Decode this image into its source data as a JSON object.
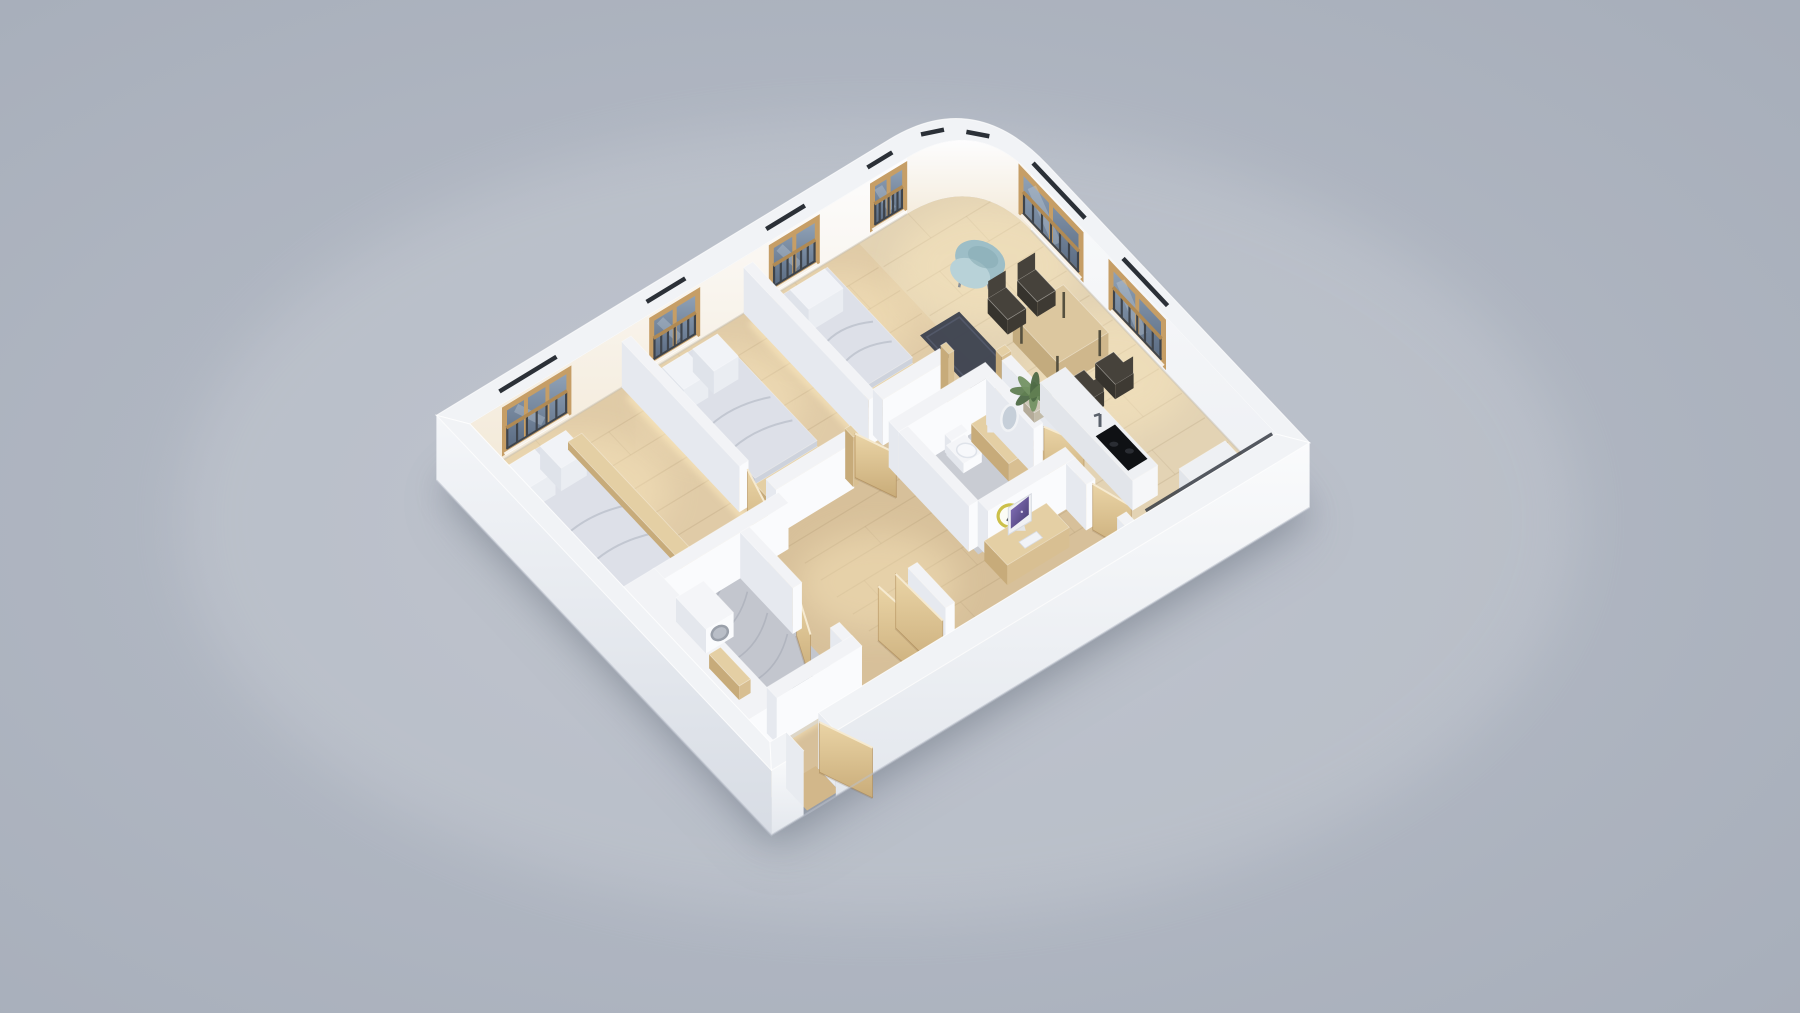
{
  "meta": {
    "view": "isometric-dollhouse-floor-plan-render",
    "content": "3d rendered apartment floor plan on plain gray backdrop, no text or ui chrome visible"
  },
  "palette": {
    "bgEdge": "#a6adb9",
    "bgMid": "#b8bec9",
    "bgLight": "#d8dbe0",
    "shadow": "#59626f",
    "plate": "#d8c3a0",
    "floorLiving": "#e3d3b4",
    "floorBed": "#e0cba7",
    "floorHall": "#d7c09a",
    "floorMarble": "#c3c6ce",
    "floorBath1": "#c9ccd3",
    "plank": "#8d7452",
    "veins": "#9fa3af",
    "glowWarm": "#ffedc2",
    "rug": "#3d4350",
    "rugLine": "#565d6e",
    "ringTop": "#f1f3f6",
    "nwFaceTop": "#fdfdfe",
    "nwFaceBot": "#f3e9d7",
    "neFaceTop": "#f9fafb",
    "neFaceBot": "#eef0f4",
    "swFaceTop": "#f4f6f9",
    "swFaceBot": "#d7dce4",
    "seFaceTop": "#fafbfc",
    "seFaceBot": "#e3e7ed",
    "glassTop": "#93a5ba",
    "glassBot": "#57687f",
    "frameWood": "#c69e66",
    "frameWoodDark": "#a98350",
    "railDark": "#3e444c",
    "railWood": "#b08a54",
    "lintel": "#2b3037",
    "wallTop": "#f2f3f6",
    "wallLeft": "#e6e9ef",
    "wallRight": "#fafbfd",
    "woodTop": "#e4cfa4",
    "woodLeft": "#c7ab7a",
    "woodRight": "#d8bf92",
    "marbleTop": "#eef0f3",
    "marbleLeft": "#e2e5ea",
    "marbleRight": "#f6f7f9",
    "whTop": "#f4f5f8",
    "whLeft": "#e4e7ed",
    "whRight": "#fafbfd",
    "cooktop": "#0f1114",
    "duvTop": "#dde0e8",
    "duvLeft": "#c2c7d3",
    "duvRight": "#cdd2dc",
    "pillow": "#f1f3f7",
    "foldLine": "#b6bcc8",
    "clockRing": "#ccc04a",
    "clockFace": "#fcfcf5",
    "hand": "#3a3f45",
    "screen1": "#8a76c2",
    "screen2": "#43386b",
    "bezel": "#f0f1f4",
    "plantG1": "#4e6a46",
    "plantG2": "#618052",
    "plantG3": "#739263",
    "pot": "#cec7b8",
    "chairDark": "#46423b",
    "chairDarker": "#36332d",
    "armTeal": "#9dbec7",
    "armTealLight": "#b8d2d8",
    "armTealDark": "#85a9b3",
    "woodPanel1": "#ead4a6",
    "woodPanel2": "#c9ac79",
    "stoolTop": "#455469",
    "stoolSide": "#38465a",
    "steel": "#5a616b",
    "threshold": "#d2b78a",
    "washerRing": "#9aa0aa",
    "washerGlass": "#b9bec7"
  },
  "projection": {
    "origin": [
      470,
      480
    ],
    "u_axis": [
      46,
      -28
    ],
    "v_axis": [
      50,
      53
    ],
    "units_long": 11,
    "units_short": 6,
    "wall_lift": 56,
    "wall_thickness": 0.35,
    "curve_start_u": 9.5,
    "curve_end_v": 1.1,
    "entry_gap": [
      0.35,
      1.05
    ]
  },
  "perimeter": {
    "windows_nw": [
      {
        "span": [
          0.75,
          2.15
        ],
        "panes": 3
      },
      {
        "span": [
          3.95,
          4.95
        ],
        "panes": 2
      },
      {
        "span": [
          6.55,
          7.55
        ],
        "panes": 2
      },
      {
        "span": [
          8.75,
          9.45
        ],
        "panes": 2
      }
    ],
    "windows_ne": [
      {
        "span": [
          0.9,
          2.1
        ],
        "panes": 2
      },
      {
        "span": [
          2.7,
          3.75
        ],
        "panes": 2
      }
    ],
    "curve_ticks": [
      [
        10.0,
        -0.18,
        10.38,
        -0.07
      ],
      [
        10.66,
        0.12,
        10.92,
        0.34
      ]
    ]
  },
  "rooms": [
    {
      "id": "living-dining-kitchen",
      "floor": "wood"
    },
    {
      "id": "bedroom-1",
      "floor": "wood"
    },
    {
      "id": "bedroom-2",
      "floor": "wood"
    },
    {
      "id": "bedroom-3-master",
      "floor": "wood"
    },
    {
      "id": "bathroom-1",
      "floor": "stone"
    },
    {
      "id": "bathroom-2",
      "floor": "marble"
    },
    {
      "id": "hallway-entry",
      "floor": "wood"
    }
  ],
  "items": [
    {
      "id": "floor-plate",
      "t": "plate"
    },
    {
      "id": "floor-living",
      "t": "floor",
      "r": [
        8.45,
        0,
        11,
        6
      ],
      "c": "floorLiving"
    },
    {
      "id": "floor-bedroom-1",
      "t": "floor",
      "r": [
        6.05,
        0,
        8.45,
        2.6
      ],
      "c": "floorBed"
    },
    {
      "id": "floor-bedroom-2",
      "t": "floor",
      "r": [
        3.4,
        0,
        6.05,
        2.8
      ],
      "c": "floorBed"
    },
    {
      "id": "floor-bedroom-3",
      "t": "floor",
      "r": [
        0,
        0,
        3.4,
        3.05
      ],
      "c": "floorBed"
    },
    {
      "id": "floor-hall-a",
      "t": "floor",
      "r": [
        3.5,
        2.8,
        8.45,
        6
      ],
      "c": "floorHall"
    },
    {
      "id": "floor-hall-b",
      "t": "floor",
      "r": [
        2.55,
        3.05,
        3.5,
        6
      ],
      "c": "floorHall"
    },
    {
      "id": "floor-entry",
      "t": "floor",
      "r": [
        0.3,
        5.4,
        2.55,
        6
      ],
      "c": "floorHall"
    },
    {
      "t": "planks",
      "r": [
        8.45,
        0,
        11,
        6
      ],
      "n": 13
    },
    {
      "t": "planks",
      "r": [
        3.5,
        2.8,
        8.45,
        6
      ],
      "n": 10
    },
    {
      "t": "planks",
      "r": [
        6.05,
        0,
        8.45,
        2.6
      ],
      "n": 6
    },
    {
      "t": "planks",
      "r": [
        3.4,
        0,
        6.05,
        2.8
      ],
      "n": 6
    },
    {
      "t": "planks",
      "r": [
        0,
        0,
        3.4,
        3.05
      ],
      "n": 7
    },
    {
      "id": "floor-bathroom-2",
      "t": "floor",
      "r": [
        0.8,
        3.05,
        2.55,
        5.45
      ],
      "c": "floorMarble"
    },
    {
      "id": "floor-bathroom-1",
      "t": "floor",
      "r": [
        6.05,
        3.0,
        8.05,
        4.6
      ],
      "c": "floorBath1"
    },
    {
      "t": "veins",
      "r": [
        0.8,
        3.05,
        2.55,
        5.45
      ],
      "n": 6
    },
    {
      "t": "spot",
      "at": [
        1.3,
        0.9
      ],
      "rx": 95,
      "ry": 60
    },
    {
      "t": "spot",
      "at": [
        4.5,
        0.9
      ],
      "rx": 80,
      "ry": 55
    },
    {
      "t": "spot",
      "at": [
        7.2,
        0.8
      ],
      "rx": 70,
      "ry": 48
    },
    {
      "t": "spot",
      "at": [
        9.9,
        1.2
      ],
      "rx": 90,
      "ry": 60
    },
    {
      "t": "spot",
      "at": [
        10.2,
        3.4
      ],
      "rx": 80,
      "ry": 60
    },
    {
      "t": "spot",
      "at": [
        4.3,
        4.2
      ],
      "rx": 80,
      "ry": 50
    },
    {
      "t": "glowline",
      "a": [
        3.3,
        0.15
      ],
      "b": [
        3.3,
        2.9
      ]
    },
    {
      "t": "glowline",
      "a": [
        0.3,
        2.97
      ],
      "b": [
        3.25,
        2.97
      ]
    },
    {
      "t": "glowline",
      "a": [
        5.95,
        0.15
      ],
      "b": [
        5.95,
        2.6
      ]
    },
    {
      "t": "glowline",
      "a": [
        3.55,
        2.72
      ],
      "b": [
        5.15,
        2.72
      ]
    },
    {
      "t": "glowline",
      "a": [
        6.15,
        0.15
      ],
      "b": [
        6.15,
        2.38
      ]
    },
    {
      "t": "glowline",
      "a": [
        6.3,
        2.38
      ],
      "b": [
        7.5,
        2.38
      ]
    },
    {
      "t": "glowline",
      "a": [
        6.1,
        2.88
      ],
      "b": [
        8.0,
        2.88
      ]
    },
    {
      "t": "glowline",
      "a": [
        4.0,
        5.9
      ],
      "b": [
        7.8,
        5.9
      ]
    },
    {
      "t": "glowline",
      "a": [
        0.45,
        5.42
      ],
      "b": [
        2.3,
        5.42
      ]
    },
    {
      "id": "rug",
      "t": "rug",
      "r": [
        8.1,
        1.55,
        8.95,
        3.3
      ]
    },
    {
      "id": "perimeter-far",
      "t": "perimFar"
    },
    {
      "id": "bed-bedroom-1",
      "t": "bed",
      "r": [
        6.45,
        0.25,
        7.5,
        1.95
      ],
      "pillows": 1
    },
    {
      "id": "bench-bedroom-1",
      "t": "box",
      "r": [
        6.45,
        1.95,
        7.5,
        2.25
      ],
      "h": 10,
      "c": "wood"
    },
    {
      "id": "bed-bedroom-2",
      "t": "bed",
      "r": [
        3.75,
        0.25,
        5.1,
        2.25
      ],
      "pillows": 2
    },
    {
      "id": "bench-bedroom-2",
      "t": "box",
      "r": [
        3.75,
        2.25,
        5.1,
        2.55
      ],
      "h": 10,
      "c": "wood"
    },
    {
      "id": "bed-bedroom-3",
      "t": "bed",
      "r": [
        0.35,
        0.3,
        1.75,
        2.7
      ],
      "pillows": 2
    },
    {
      "id": "bench-bedroom-3",
      "t": "box",
      "r": [
        1.75,
        0.35,
        2.05,
        2.65
      ],
      "h": 8,
      "c": "wood"
    },
    {
      "id": "wall",
      "t": "box",
      "r": [
        5.95,
        0,
        6.15,
        2.5
      ],
      "h": 46,
      "c": "wall"
    },
    {
      "id": "wall",
      "t": "box",
      "r": [
        6.15,
        2.4,
        7.6,
        2.6
      ],
      "h": 46,
      "c": "wall"
    },
    {
      "id": "door-frame",
      "t": "box",
      "r": [
        7.6,
        2.42,
        7.72,
        2.58
      ],
      "h": 50,
      "c": "wood"
    },
    {
      "id": "wall",
      "t": "box",
      "r": [
        3.5,
        2.7,
        5.2,
        2.9
      ],
      "h": 46,
      "c": "wall"
    },
    {
      "id": "door-frame",
      "t": "box",
      "r": [
        5.2,
        2.72,
        5.32,
        2.88
      ],
      "h": 50,
      "c": "wood"
    },
    {
      "id": "door-leaf",
      "t": "panel",
      "at": [
        5.35,
        2.78
      ],
      "dir": [
        0.5,
        0.87
      ],
      "len": 0.62,
      "h": 44
    },
    {
      "id": "wall",
      "t": "box",
      "r": [
        3.3,
        0,
        3.5,
        2.35
      ],
      "h": 46,
      "c": "wall"
    },
    {
      "id": "door-leaf",
      "t": "panel",
      "at": [
        3.4,
        2.42
      ],
      "dir": [
        -0.35,
        0.94
      ],
      "len": 0.65,
      "h": 44
    },
    {
      "id": "wall",
      "t": "box",
      "r": [
        0.75,
        2.95,
        3.5,
        3.15
      ],
      "h": 46,
      "c": "wall"
    },
    {
      "id": "closet-volume",
      "t": "box",
      "r": [
        0,
        2.95,
        0.8,
        5.45
      ],
      "h": 46,
      "c": "wall"
    },
    {
      "id": "washing-machine",
      "t": "washer",
      "r": [
        1.0,
        3.2,
        1.6,
        3.8
      ],
      "h": 24
    },
    {
      "id": "bath-shelf",
      "t": "box",
      "r": [
        0.85,
        4.0,
        1.1,
        4.6
      ],
      "h": 14,
      "c": "wood"
    },
    {
      "id": "stool",
      "t": "stool",
      "at": [
        1.85,
        4.95
      ]
    },
    {
      "id": "door-leaf",
      "t": "panel",
      "at": [
        2.48,
        4.25
      ],
      "dir": [
        -0.52,
        0.85
      ],
      "len": 0.75,
      "h": 46
    },
    {
      "id": "wall",
      "t": "box",
      "r": [
        2.45,
        3.15,
        2.65,
        4.2
      ],
      "h": 46,
      "c": "wall"
    },
    {
      "id": "wall",
      "t": "box",
      "r": [
        2.45,
        4.95,
        2.65,
        5.4
      ],
      "h": 46,
      "c": "wall"
    },
    {
      "id": "wall",
      "t": "box",
      "r": [
        0.8,
        5.2,
        2.65,
        5.4
      ],
      "h": 46,
      "c": "wall"
    },
    {
      "id": "door-frame",
      "t": "box",
      "r": [
        8.3,
        2.88,
        8.5,
        3.0
      ],
      "h": 50,
      "c": "wood"
    },
    {
      "id": "wall",
      "t": "box",
      "r": [
        8.3,
        3.0,
        8.5,
        4.4
      ],
      "h": 46,
      "c": "wall"
    },
    {
      "id": "wall",
      "t": "box",
      "r": [
        5.95,
        2.9,
        8.05,
        3.1
      ],
      "h": 46,
      "c": "wall"
    },
    {
      "id": "toilet",
      "t": "toilet",
      "r": [
        6.9,
        3.18,
        7.3,
        3.52
      ]
    },
    {
      "id": "vanity",
      "t": "box",
      "r": [
        7.42,
        3.2,
        7.98,
        3.95
      ],
      "h": 18,
      "c": "wood"
    },
    {
      "id": "basin",
      "t": "basin",
      "at": [
        7.68,
        3.5
      ]
    },
    {
      "id": "wall",
      "t": "box",
      "r": [
        7.85,
        3.1,
        8.05,
        4.05
      ],
      "h": 46,
      "c": "wall"
    },
    {
      "id": "mirror",
      "t": "mirror",
      "at": [
        7.87,
        3.55
      ]
    },
    {
      "id": "door-leaf",
      "t": "panel",
      "at": [
        8.02,
        4.1
      ],
      "dir": [
        0.55,
        0.83
      ],
      "len": 0.6,
      "h": 46
    },
    {
      "id": "wall",
      "t": "box",
      "r": [
        5.95,
        3.1,
        6.15,
        4.5
      ],
      "h": 46,
      "c": "wall"
    },
    {
      "id": "wall",
      "t": "box",
      "r": [
        6.15,
        4.5,
        8.05,
        4.7
      ],
      "h": 46,
      "c": "wall"
    },
    {
      "id": "wall-clock",
      "t": "clock",
      "at": [
        6.6,
        4.73
      ]
    },
    {
      "id": "desk",
      "t": "box",
      "r": [
        6.05,
        4.72,
        7.4,
        5.18
      ],
      "h": 20,
      "c": "wood"
    },
    {
      "id": "monitor",
      "t": "monitor",
      "a": [
        6.42,
        4.86
      ],
      "b": [
        6.92,
        4.86
      ]
    },
    {
      "id": "keyboard",
      "t": "flat",
      "r": [
        6.5,
        5.0,
        6.88,
        5.12
      ],
      "lift": 21,
      "c": "pillow"
    },
    {
      "id": "wall",
      "t": "box",
      "r": [
        7.85,
        4.7,
        8.05,
        5.1
      ],
      "h": 46,
      "c": "wall"
    },
    {
      "id": "door-leaf",
      "t": "panel",
      "at": [
        7.95,
        5.14
      ],
      "dir": [
        0.4,
        0.92
      ],
      "len": 0.6,
      "h": 46
    },
    {
      "id": "wall",
      "t": "box",
      "r": [
        7.85,
        5.72,
        8.05,
        5.95
      ],
      "h": 46,
      "c": "wall"
    },
    {
      "id": "wall",
      "t": "box",
      "r": [
        4.25,
        4.85,
        4.45,
        5.6
      ],
      "h": 50,
      "c": "wall"
    },
    {
      "id": "wardrobe-door",
      "t": "panel",
      "at": [
        3.55,
        4.9
      ],
      "dir": [
        0.12,
        0.99
      ],
      "len": 0.85,
      "h": 54
    },
    {
      "id": "wardrobe-door",
      "t": "panel",
      "at": [
        3.95,
        4.88
      ],
      "dir": [
        0.05,
        1.0
      ],
      "len": 0.9,
      "h": 54
    },
    {
      "id": "plant",
      "t": "plant",
      "at": [
        8.65,
        3.32
      ]
    },
    {
      "id": "armchair",
      "t": "armchair",
      "at": [
        9.72,
        1.12
      ]
    },
    {
      "id": "dining-table",
      "t": "table",
      "r": [
        9.3,
        2.3,
        10.4,
        3.2
      ],
      "h": 26
    },
    {
      "id": "chair",
      "t": "chair",
      "at": [
        9.52,
        1.98
      ],
      "back": "nw"
    },
    {
      "id": "chair",
      "t": "chair",
      "at": [
        10.16,
        1.98
      ],
      "back": "nw"
    },
    {
      "id": "chair",
      "t": "chair",
      "at": [
        9.52,
        3.54
      ],
      "back": "se"
    },
    {
      "id": "chair",
      "t": "chair",
      "at": [
        10.16,
        3.54
      ],
      "back": "se"
    },
    {
      "id": "kitchen-island",
      "t": "box",
      "r": [
        8.75,
        3.35,
        9.3,
        5.2
      ],
      "h": 30,
      "c": "marble"
    },
    {
      "id": "cooktop",
      "t": "cooktop",
      "r": [
        8.82,
        4.4,
        9.24,
        5.05
      ],
      "lift": 30
    },
    {
      "id": "faucet",
      "t": "faucet",
      "at": [
        9.0,
        4.32
      ],
      "lift": 30
    },
    {
      "id": "kitchen-counter",
      "t": "box",
      "r": [
        9.6,
        5.35,
        10.6,
        5.93
      ],
      "h": 26,
      "c": "marble"
    },
    {
      "id": "balcony-edge",
      "t": "darkline",
      "a": [
        8.2,
        5.97
      ],
      "b": [
        10.95,
        5.97
      ],
      "lift": 56
    },
    {
      "id": "perimeter-near",
      "t": "perimNear"
    }
  ]
}
